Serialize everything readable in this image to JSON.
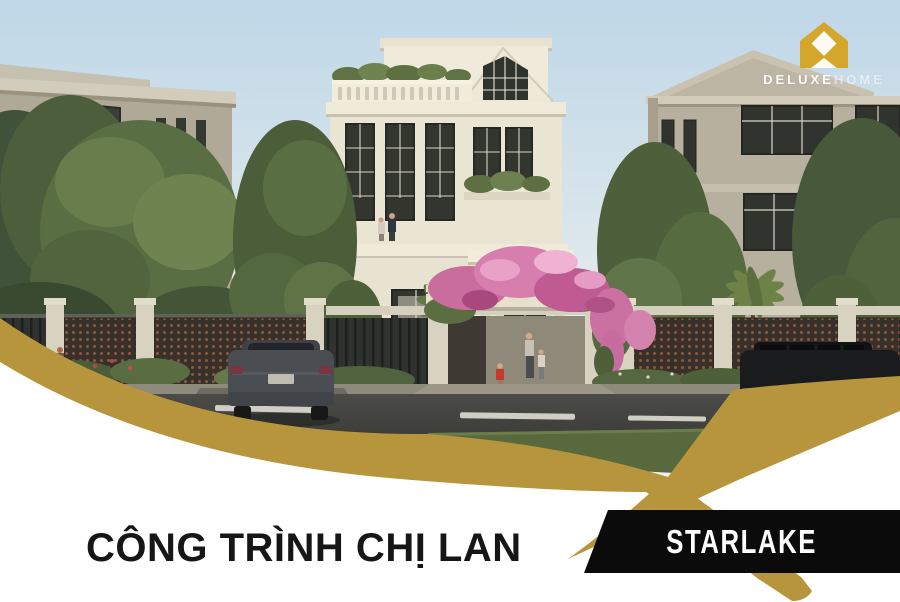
{
  "colors": {
    "accent_gold": "#B6953C",
    "badge_bg": "#0B0B0B",
    "badge_text": "#FFFFFF",
    "title_text": "#161616",
    "logo_gold": "#D4A72C",
    "logo_text": "#FFFFFF",
    "page_bg": "#FFFFFF"
  },
  "logo": {
    "brand_part1": "DELUXE",
    "brand_part2": "HOME",
    "icon_name": "deluxe-home-house-icon"
  },
  "footer": {
    "project_title": "CÔNG TRÌNH CHỊ LAN",
    "location_badge": "STARLAKE"
  }
}
